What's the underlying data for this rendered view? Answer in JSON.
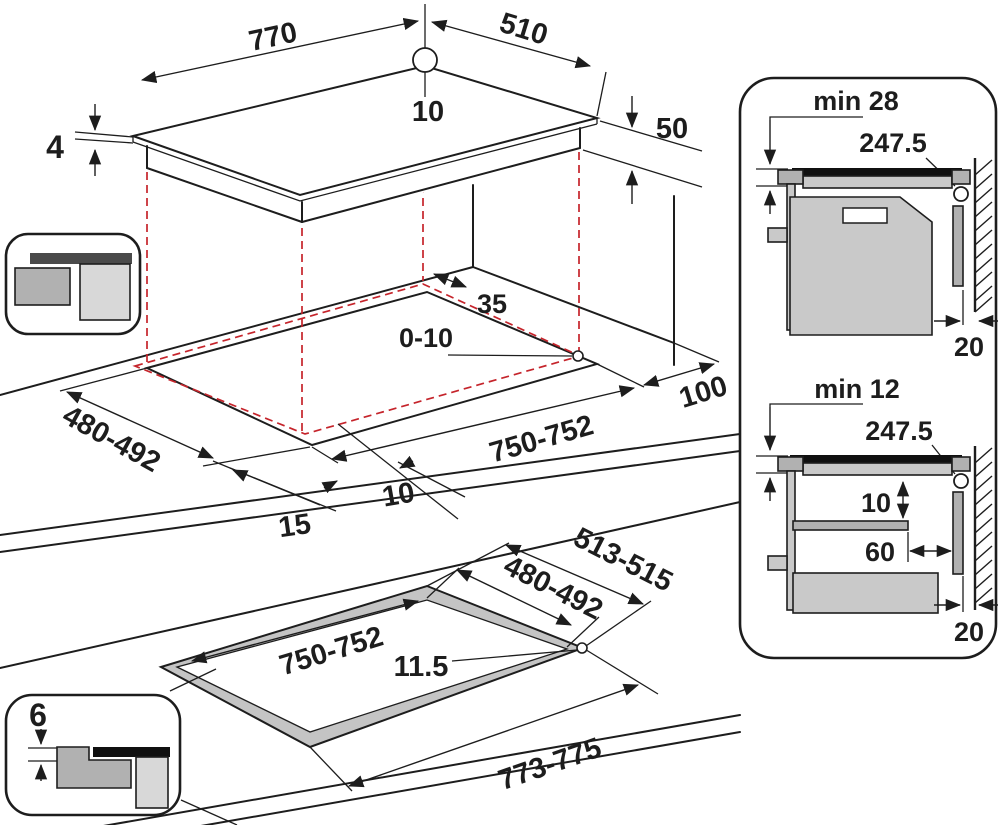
{
  "title": "Built-in hob installation dimensions diagram",
  "colors": {
    "line": "#1d1d1d",
    "projection_red": "#c5242b",
    "gray_mid": "#c9c9c9",
    "gray_dark": "#b1b1b1",
    "gray_light": "#d8d8d8",
    "part_black": "#101010"
  },
  "hob_top_view": {
    "width": "770",
    "depth": "510",
    "hole_offset": "10",
    "glass_thickness": "4",
    "body_depth": "50"
  },
  "worktop_cutout_view": {
    "rear_gap": "35",
    "side_gap": "0-10",
    "wall_distance": "100",
    "cutout_depth": "480-492",
    "cutout_width": "750-752",
    "front_overhang": "15",
    "side_overhang": "10"
  },
  "flush_cutout_view": {
    "recess_depth": "513-515",
    "opening_depth": "480-492",
    "opening_width": "750-752",
    "step_width": "11.5",
    "recess_width": "773-775"
  },
  "flush_section_inset": {
    "step_depth": "6"
  },
  "clearance_panel": {
    "oven_install": {
      "clearance": "min 28",
      "junction_box": "247.5",
      "wall_gap": "20"
    },
    "drawer_install": {
      "clearance": "min 12",
      "junction_box": "247.5",
      "shelf_gap": "10",
      "drawer_gap": "60",
      "wall_gap": "20"
    }
  }
}
